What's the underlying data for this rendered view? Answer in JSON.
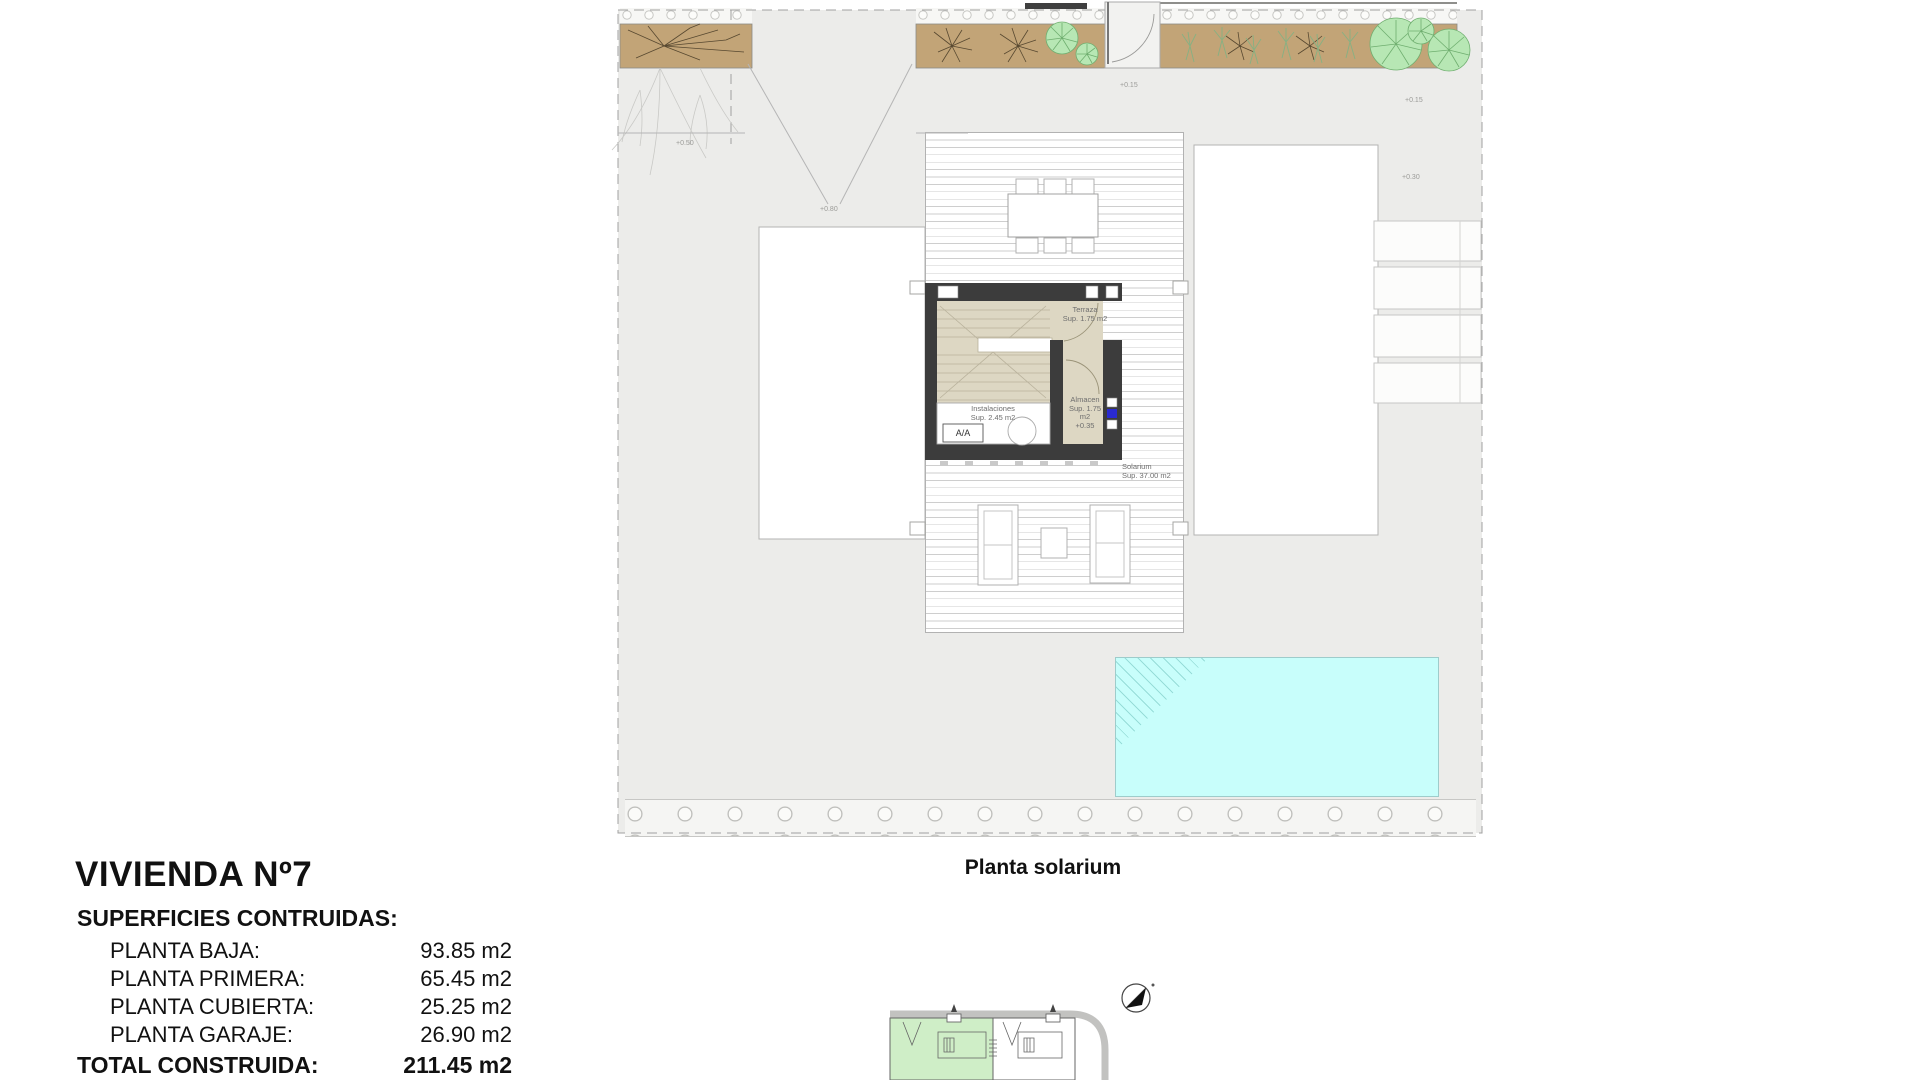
{
  "title_block": {
    "title": "VIVIENDA Nº7",
    "subtitle": "SUPERFICIES CONTRUIDAS:",
    "rows": [
      {
        "label": "PLANTA BAJA:",
        "value": "93.85 m2"
      },
      {
        "label": "PLANTA PRIMERA:",
        "value": "65.45 m2"
      },
      {
        "label": "PLANTA CUBIERTA:",
        "value": "25.25 m2"
      },
      {
        "label": "PLANTA GARAJE:",
        "value": "26.90 m2"
      }
    ],
    "total_label": "TOTAL CONSTRUIDA:",
    "total_value": "211.45 m2"
  },
  "drawing": {
    "caption": "Planta solarium",
    "labels": {
      "terraza": {
        "name": "Terraza",
        "area": "Sup. 1.75 m2"
      },
      "instalaciones": {
        "name": "Instalaciones",
        "area": "Sup. 2.45 m2"
      },
      "almacen": {
        "name": "Almacen",
        "area": "Sup. 1.75 m2",
        "level": "+0.35"
      },
      "solarium": {
        "name": "Solarium",
        "area": "Sup. 37.00 m2"
      },
      "aa_unit": "A/A"
    },
    "level_markers": [
      {
        "text": "+0.15"
      },
      {
        "text": "+0.15"
      },
      {
        "text": "+0.30"
      },
      {
        "text": "+0.50"
      },
      {
        "text": "+0.80"
      }
    ]
  },
  "colors": {
    "plot_fill": "#ececea",
    "planter_fill": "#c2a477",
    "core_wall": "#3c3c3c",
    "core_floor": "#ddd7c3",
    "pool_fill": "#c8fefb",
    "tree_fill": "#b7e7b4",
    "minimap_highlight": "#cfeec7",
    "marker_blue": "#2a2ad0"
  }
}
